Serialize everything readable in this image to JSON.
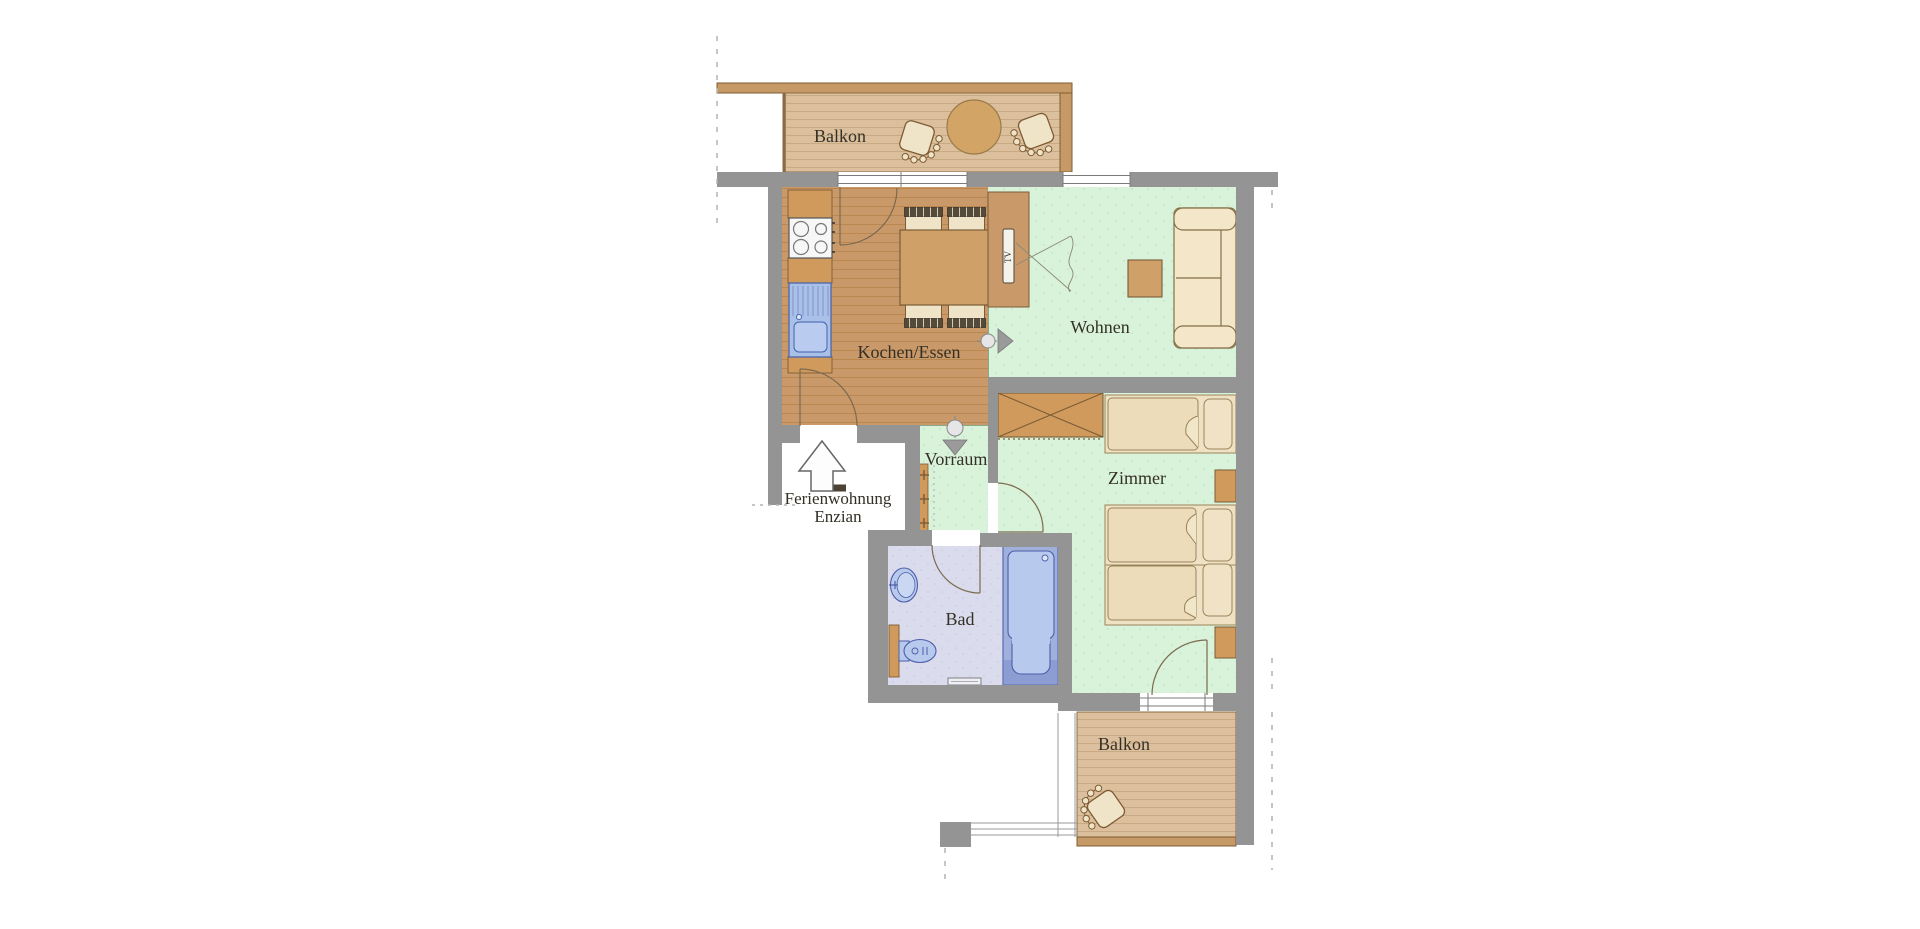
{
  "title": {
    "line1": "Ferienwohnung",
    "line2": "Enzian"
  },
  "rooms": {
    "balcony_top": {
      "label": "Balkon"
    },
    "kitchen": {
      "label": "Kochen/Essen"
    },
    "living": {
      "label": "Wohnen"
    },
    "hallway": {
      "label": "Vorraum"
    },
    "bedroom": {
      "label": "Zimmer"
    },
    "bathroom": {
      "label": "Bad"
    },
    "balcony_bottom": {
      "label": "Balkon"
    }
  },
  "furniture": {
    "tv_label": "TV"
  },
  "colors": {
    "wall": "#949494",
    "wood_floor": "#c9996a",
    "balcony_floor": "#dcc09e",
    "rail_brown": "#c69a66",
    "furniture_brown": "#cf9a5c",
    "green_floor": "#d9f2da",
    "bath_floor": "#dadbec",
    "fixture_blue": "#a9c0e8",
    "cream": "#f0e4c8",
    "label_text": "#343026"
  }
}
